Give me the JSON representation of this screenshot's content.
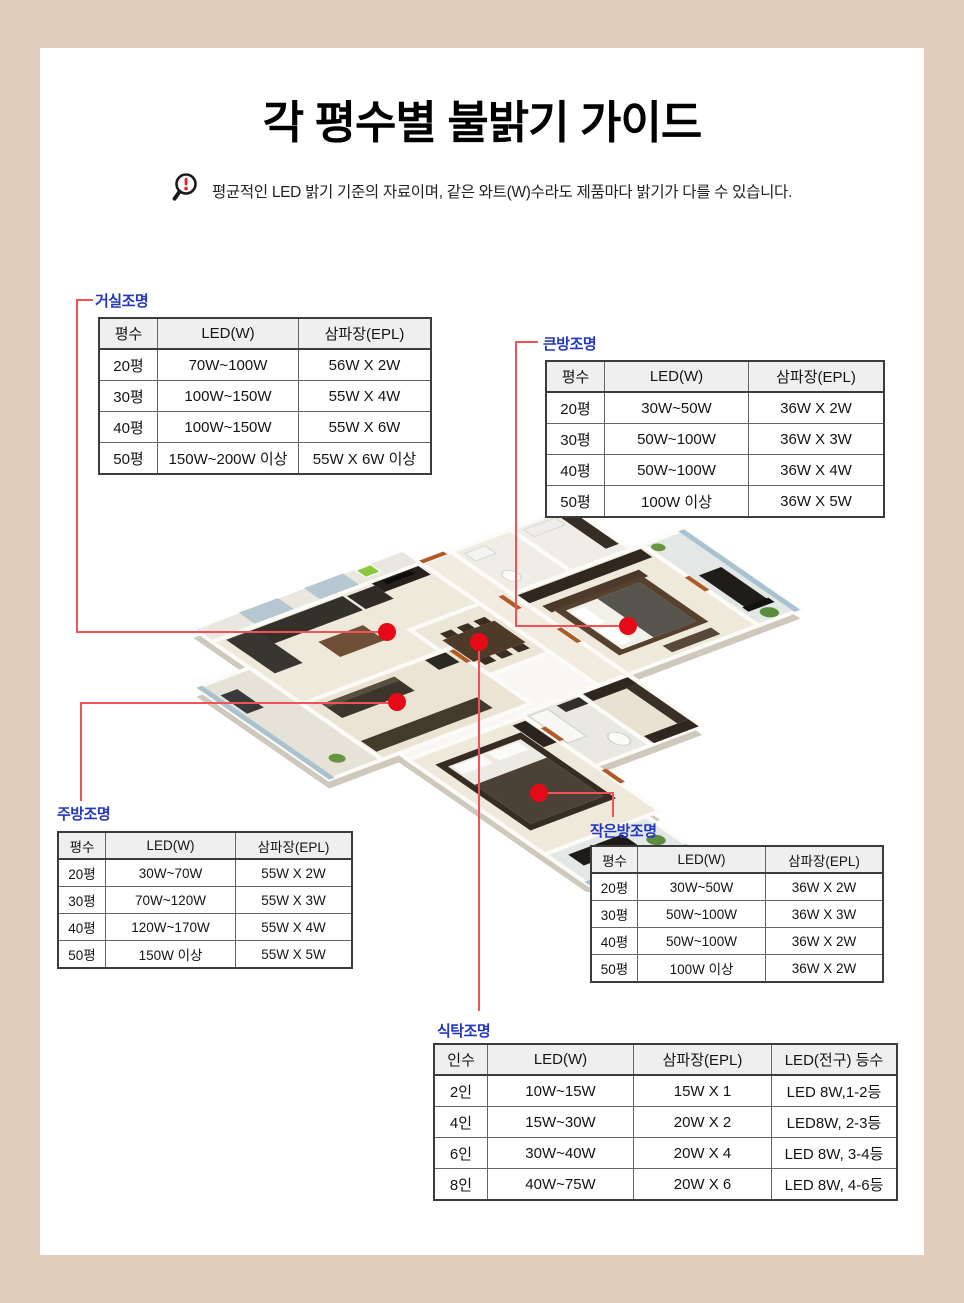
{
  "page": {
    "title": "각 평수별 불밝기 가이드",
    "notice": "평균적인 LED 밝기 기준의 자료이며, 같은 와트(W)수라도 제품마다 밝기가 다를 수 있습니다."
  },
  "colors": {
    "frame_beige": "#e2cebd",
    "label_blue": "#2438bb",
    "leader_red": "#ef5358",
    "marker_red": "#e60a18",
    "header_gray": "#efefef"
  },
  "sections": {
    "living": {
      "label": "거실조명",
      "headers": [
        "평수",
        "LED(W)",
        "삼파장(EPL)"
      ],
      "rows": [
        [
          "20평",
          "70W~100W",
          "56W X 2W"
        ],
        [
          "30평",
          "100W~150W",
          "55W X 4W"
        ],
        [
          "40평",
          "100W~150W",
          "55W X 6W"
        ],
        [
          "50평",
          "150W~200W 이상",
          "55W X 6W 이상"
        ]
      ]
    },
    "bigroom": {
      "label": "큰방조명",
      "headers": [
        "평수",
        "LED(W)",
        "삼파장(EPL)"
      ],
      "rows": [
        [
          "20평",
          "30W~50W",
          "36W X 2W"
        ],
        [
          "30평",
          "50W~100W",
          "36W X 3W"
        ],
        [
          "40평",
          "50W~100W",
          "36W X 4W"
        ],
        [
          "50평",
          "100W 이상",
          "36W X 5W"
        ]
      ]
    },
    "kitchen": {
      "label": "주방조명",
      "headers": [
        "평수",
        "LED(W)",
        "삼파장(EPL)"
      ],
      "rows": [
        [
          "20평",
          "30W~70W",
          "55W X 2W"
        ],
        [
          "30평",
          "70W~120W",
          "55W X 3W"
        ],
        [
          "40평",
          "120W~170W",
          "55W X 4W"
        ],
        [
          "50평",
          "150W 이상",
          "55W X 5W"
        ]
      ]
    },
    "smallroom": {
      "label": "작은방조명",
      "headers": [
        "평수",
        "LED(W)",
        "삼파장(EPL)"
      ],
      "rows": [
        [
          "20평",
          "30W~50W",
          "36W X 2W"
        ],
        [
          "30평",
          "50W~100W",
          "36W X 3W"
        ],
        [
          "40평",
          "50W~100W",
          "36W X 2W"
        ],
        [
          "50평",
          "100W 이상",
          "36W X 2W"
        ]
      ]
    },
    "dining": {
      "label": "식탁조명",
      "headers": [
        "인수",
        "LED(W)",
        "삼파장(EPL)",
        "LED(전구) 등수"
      ],
      "rows": [
        [
          "2인",
          "10W~15W",
          "15W X 1",
          "LED 8W,1-2등"
        ],
        [
          "4인",
          "15W~30W",
          "20W X 2",
          "LED8W, 2-3등"
        ],
        [
          "6인",
          "30W~40W",
          "20W X 4",
          "LED 8W, 3-4등"
        ],
        [
          "8인",
          "40W~75W",
          "20W X 6",
          "LED 8W, 4-6등"
        ]
      ]
    }
  }
}
